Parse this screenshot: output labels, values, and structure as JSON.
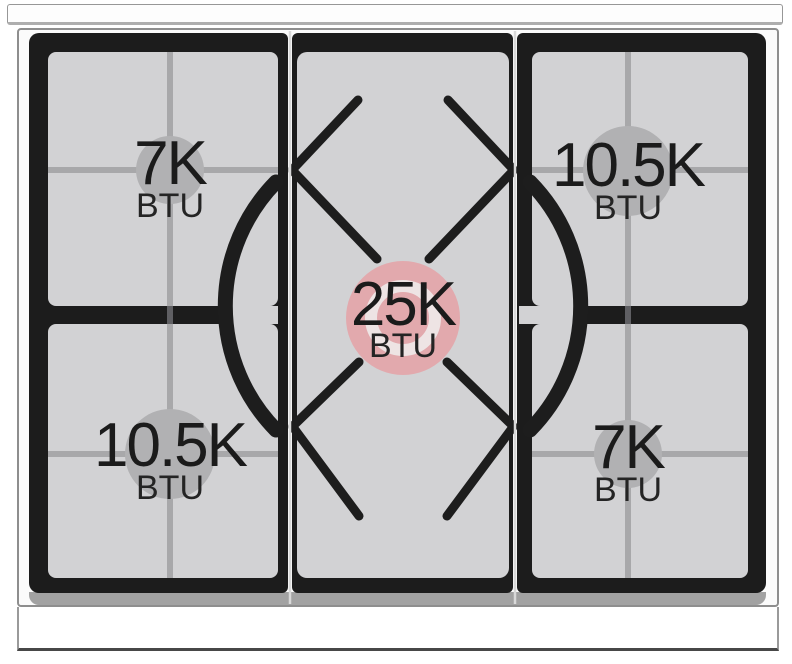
{
  "diagram": {
    "title": "gas cooktop burner power diagram",
    "burners": [
      {
        "id": "top-left",
        "value": "7K",
        "unit": "BTU",
        "highlighted": false
      },
      {
        "id": "top-right",
        "value": "10.5K",
        "unit": "BTU",
        "highlighted": false
      },
      {
        "id": "center",
        "value": "25K",
        "unit": "BTU",
        "highlighted": true
      },
      {
        "id": "bottom-left",
        "value": "10.5K",
        "unit": "BTU",
        "highlighted": false
      },
      {
        "id": "bottom-right",
        "value": "7K",
        "unit": "BTU",
        "highlighted": false
      }
    ],
    "colors": {
      "highlight_circle": "#e2a9ad",
      "burner_marker": "#b1b1b3",
      "surface_gray": "#d2d2d4",
      "grate_black": "#1c1c1c",
      "cross_line": "#a8a8aa",
      "divider_line": "#d9d9d9"
    }
  }
}
